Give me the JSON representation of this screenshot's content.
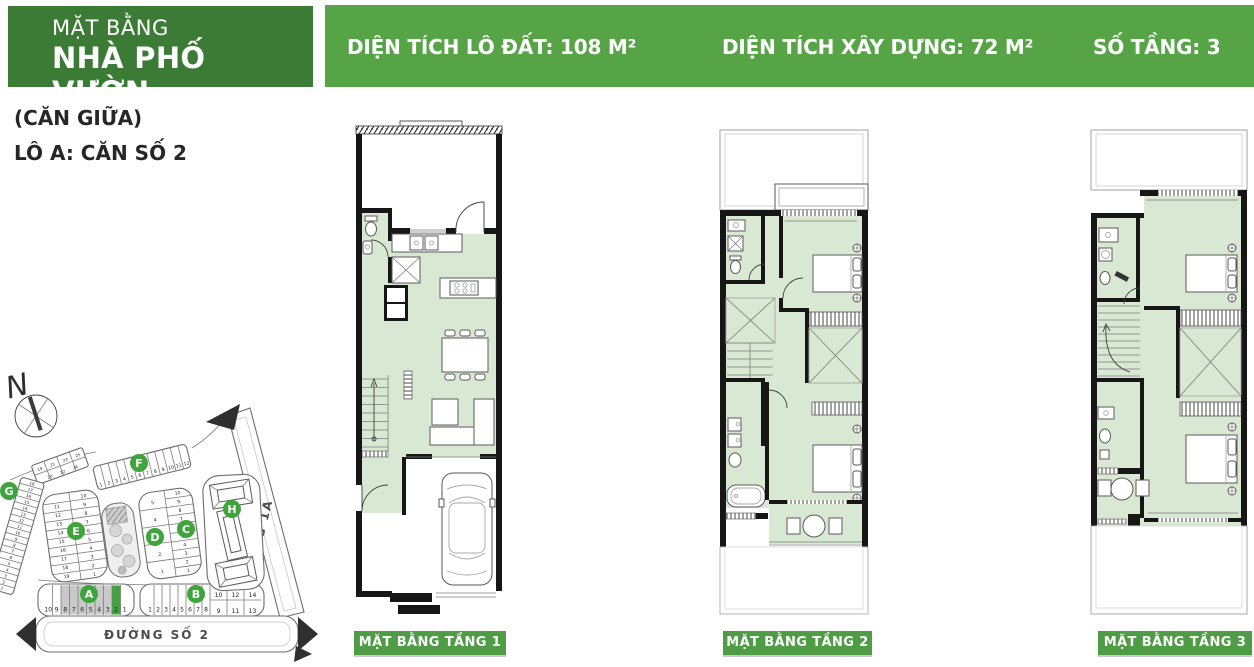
{
  "page_title": "MẶT BẰNG NHÀ PHỐ VƯỜN",
  "header": {
    "banner": {
      "line1": "MẶT BẰNG",
      "line2": "NHÀ PHỐ VƯỜN"
    },
    "unit_note": "(CĂN GIỮA)",
    "unit_label": "LÔ A: CĂN SỐ 2",
    "stats": [
      {
        "text": "DIỆN TÍCH LÔ ĐẤT: 108 M²",
        "value_m2": 108
      },
      {
        "text": "DIỆN TÍCH XÂY DỰNG: 72 M²",
        "value_m2": 72
      },
      {
        "text": "SỐ TẦNG: 3",
        "value": 3
      }
    ]
  },
  "floors": [
    {
      "label": "MẶT BẰNG TẦNG 1"
    },
    {
      "label": "MẶT BẰNG TẦNG 2"
    },
    {
      "label": "MẶT BẰNG TẦNG 3"
    }
  ],
  "site_plan": {
    "compass_label": "N",
    "streets": [
      {
        "name": "ĐƯỜNG SỐ 2"
      },
      {
        "name": "ĐƯỜNG 1A"
      }
    ],
    "highlight": {
      "block": "A",
      "lot": "2"
    },
    "blocks": [
      {
        "id": "A",
        "lots": [
          "10",
          "9",
          "8",
          "7",
          "6",
          "5",
          "4",
          "3",
          "2",
          "1"
        ],
        "highlighted_lot": "2"
      },
      {
        "id": "B",
        "lots_front": [
          "1",
          "2",
          "3",
          "4",
          "5",
          "6",
          "7",
          "8"
        ],
        "lots_back_upper": [
          "10",
          "12",
          "14"
        ],
        "lots_back_lower": [
          "9",
          "11",
          "13"
        ]
      },
      {
        "id": "C",
        "lots": [
          "10",
          "9",
          "8",
          "7",
          "6",
          "5",
          "4",
          "3",
          "2",
          "1"
        ]
      },
      {
        "id": "D",
        "lots": [
          "5",
          "4",
          "3",
          "2",
          "1"
        ]
      },
      {
        "id": "E",
        "lots_left": [
          "11",
          "12",
          "13",
          "14",
          "15",
          "16",
          "17",
          "18",
          "19"
        ],
        "lots_right": [
          "10",
          "9",
          "8",
          "7",
          "6",
          "5",
          "4",
          "3",
          "2",
          "1"
        ]
      },
      {
        "id": "F",
        "lots": [
          "1",
          "2",
          "3",
          "4",
          "5",
          "6",
          "7",
          "8",
          "9",
          "10",
          "11",
          "12"
        ]
      },
      {
        "id": "G",
        "lots": [
          "18",
          "17",
          "16",
          "15",
          "14",
          "13",
          "12",
          "11",
          "10",
          "9",
          "8",
          "7",
          "6",
          "5",
          "4",
          "3",
          "2",
          "1"
        ]
      },
      {
        "id": "H"
      }
    ],
    "corner_rows": {
      "upper": [
        "19",
        "21",
        "23",
        "25"
      ],
      "lower": [
        "20",
        "22",
        "24"
      ]
    }
  },
  "colors": {
    "banner_green": "#3c7b36",
    "strip_green": "#57a447",
    "caption_green": "#4e9c44",
    "badge_green": "#3fa43c",
    "highlight_lot_green": "#3fa43c",
    "plan_floor_green": "#d9e8d2",
    "lot_gray": "#c9c9c9"
  }
}
